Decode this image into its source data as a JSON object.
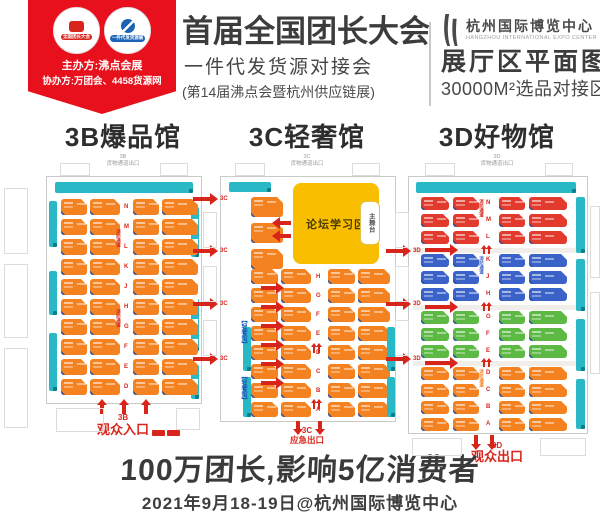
{
  "header": {
    "ribbon": {
      "badge1_label": "全国团长大会",
      "badge2_label": "一件代发货源展",
      "host_line": "主办方:沸点会展",
      "co_host_line": "协办方:万团会、4458货源网"
    },
    "title": "首届全国团长大会",
    "subtitle": "一件代发货源对接会",
    "subtitle_note": "(第14届沸点会暨杭州供应链展)",
    "venue": {
      "name_cn": "杭州国际博览中心",
      "name_en": "HANGZHOU INTERNATIONAL EXPO CENTER",
      "map_title": "展厅区平面图",
      "area_line": "30000M²选品对接区"
    }
  },
  "halls": [
    {
      "code": "3B",
      "title": "3B爆品馆",
      "top_line1": "3B",
      "top_line2": "货物通道出口",
      "bottom_code": "3B",
      "bottom_label": "观众入口",
      "aisle_note": "消防通道",
      "aisle_letters": [
        "N",
        "M",
        "L",
        "K",
        "J",
        "H",
        "G",
        "F",
        "E",
        "D"
      ],
      "bands": [
        {
          "color": "#F58220",
          "rows": 10
        }
      ]
    },
    {
      "code": "3C",
      "title": "3C轻奢馆",
      "top_line1": "3C",
      "top_line2": "货物通道出口",
      "forum_label": "论坛学习区",
      "stage_label": "主舞台",
      "side_label": "【轻奢馆】",
      "bottom_code": "3C",
      "bottom_label": "应急出口",
      "aisle_letters": [
        "H",
        "G",
        "F",
        "E",
        "D",
        "C",
        "B",
        "A"
      ],
      "bands": [
        {
          "color": "#F58220",
          "rows": 8
        }
      ]
    },
    {
      "code": "3D",
      "title": "3D好物馆",
      "top_line1": "3D",
      "top_line2": "货物通道出口",
      "bottom_code": "3D",
      "bottom_label": "观众出口",
      "aisle_note": "消防通道",
      "aisle_letters": [
        "N",
        "M",
        "L",
        "K",
        "J",
        "H",
        "G",
        "F",
        "E",
        "D",
        "C",
        "B",
        "A"
      ],
      "bands": [
        {
          "color": "#E23B2E",
          "rows": 3
        },
        {
          "color": "#3A62C8",
          "rows": 3
        },
        {
          "color": "#5CB943",
          "rows": 3
        },
        {
          "color": "#F58220",
          "rows": 4
        }
      ]
    }
  ],
  "gap_arrows": {
    "left_label": "3C",
    "right_label": "3D"
  },
  "footer": {
    "slogan": "100万团长,影响5亿消费者",
    "date_line": "2021年9月18-19日@杭州国际博览中心"
  },
  "colors": {
    "accent_red": "#E8101C",
    "arrow_red": "#D8251C",
    "teal": "#29B8C5",
    "yellow": "#F9BE00",
    "orange": "#F58220",
    "booth_red": "#E23B2E",
    "booth_blue": "#3A62C8",
    "booth_green": "#5CB943"
  }
}
